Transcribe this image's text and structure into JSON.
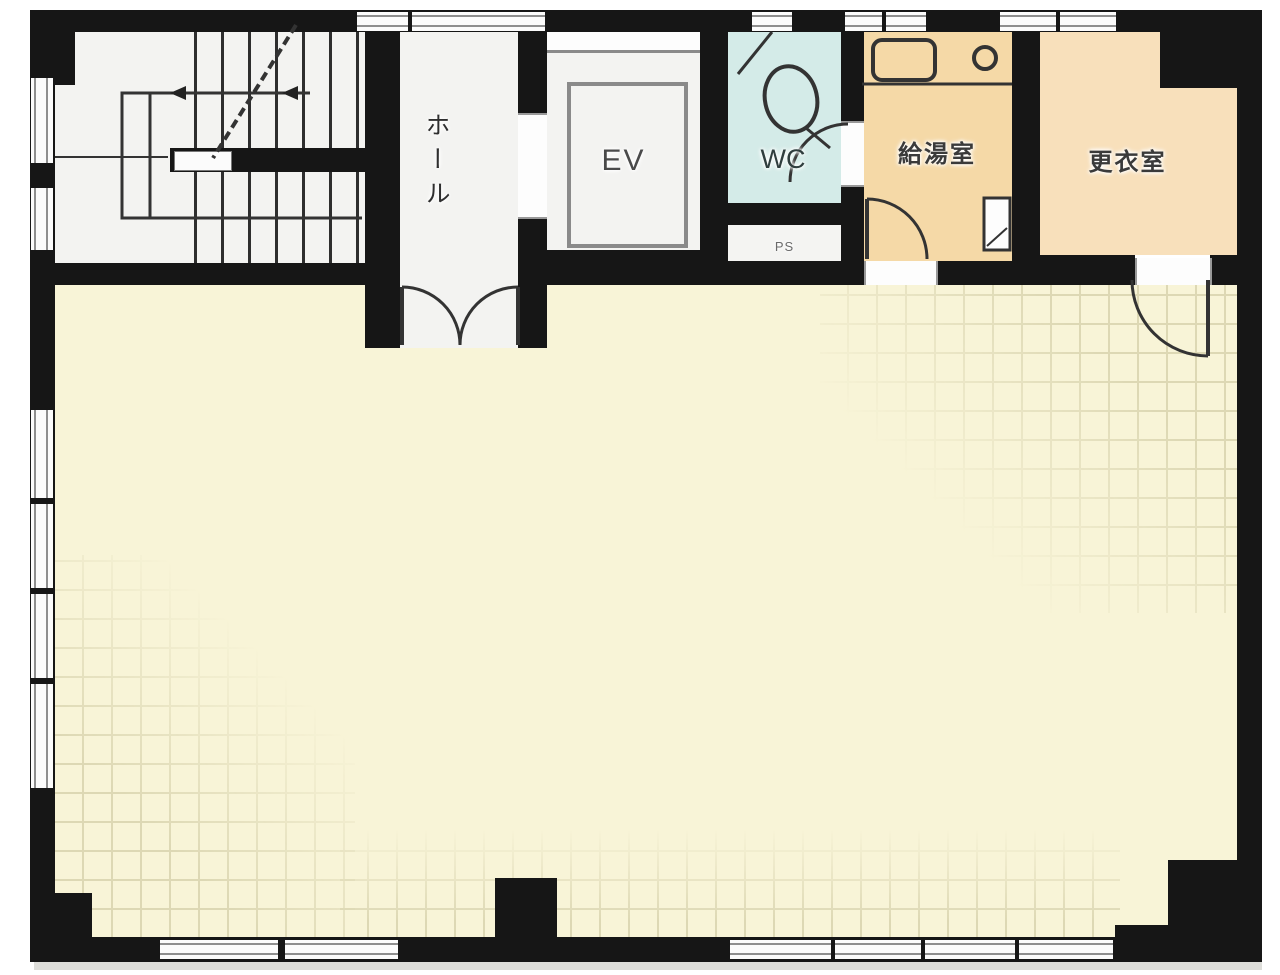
{
  "plan": {
    "type": "building-floor-plan",
    "rooms": {
      "hall": {
        "label": "ホール"
      },
      "elevator": {
        "label": "EV"
      },
      "wc": {
        "label": "WC"
      },
      "pipe_space": {
        "label": "PS"
      },
      "kitchenette": {
        "label": "給湯室"
      },
      "changing_room": {
        "label": "更衣室"
      },
      "stairwell": {
        "label": ""
      },
      "main_room": {
        "label": ""
      }
    },
    "colors": {
      "wall": "#161616",
      "floor-main": "#f8f4d7",
      "floor-wc": "#d4ebe8",
      "floor-kitchenette": "#f5d9a7",
      "floor-changing": "#f8e0bb",
      "floor-corridor": "#f3f3f1",
      "line": "#333333",
      "grid-main": "#ddd8b4",
      "grid-wc": "#a9d2ce",
      "grid-warm": "#dfba85",
      "window-frame": "#8e8e8e"
    }
  }
}
